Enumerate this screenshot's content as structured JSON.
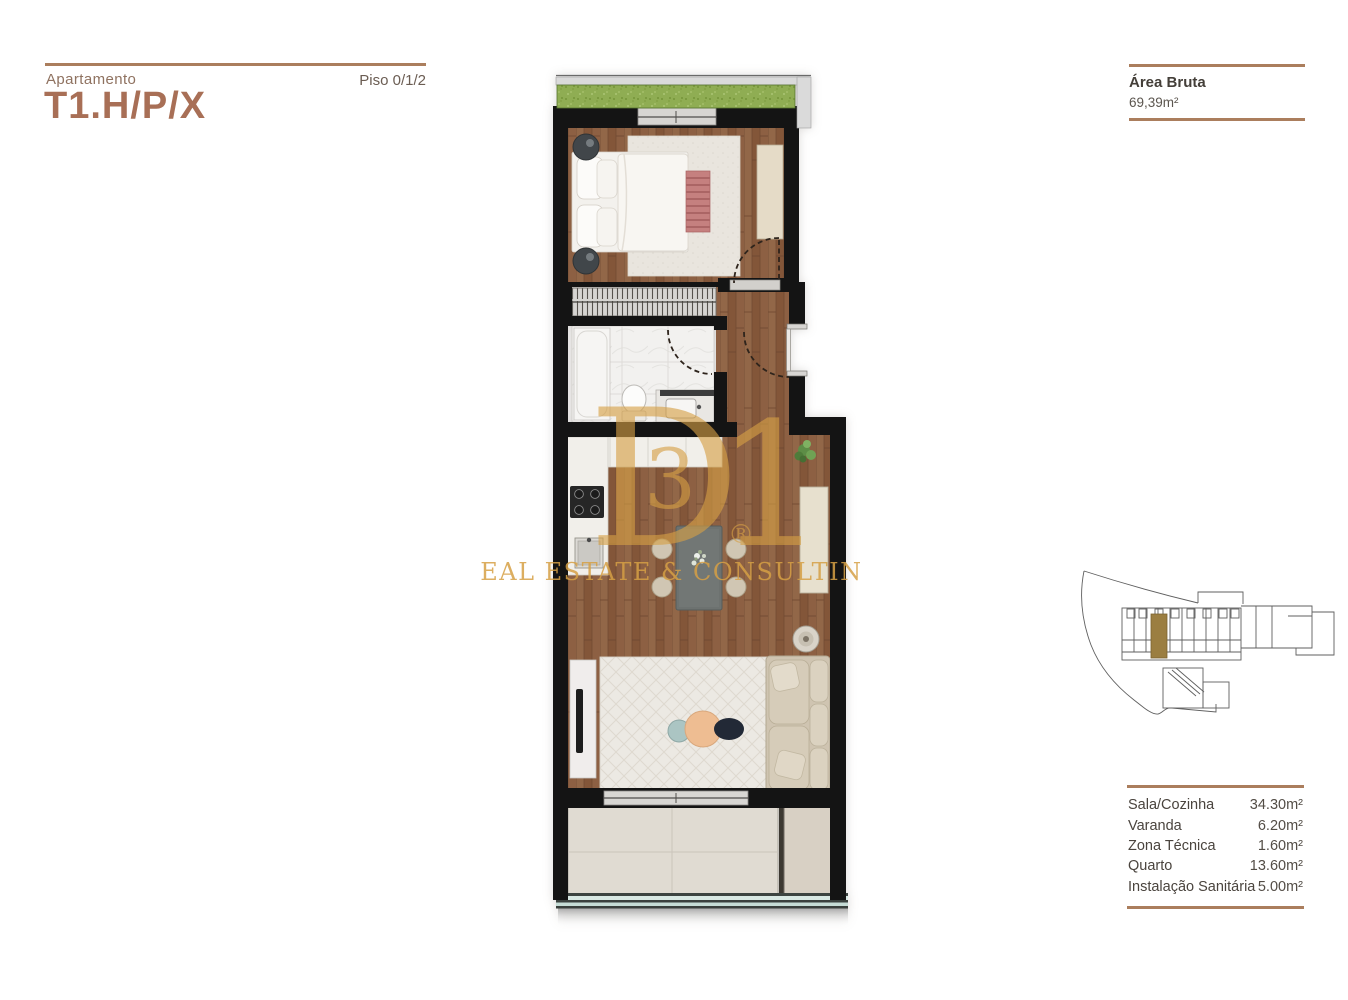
{
  "header": {
    "apartment_label": "Apartamento",
    "apartment_title": "T1.H/P/X",
    "floor_label": "Piso 0/1/2"
  },
  "gross_area": {
    "label": "Área Bruta",
    "value": "69,39m²"
  },
  "areas_table": {
    "rows": [
      {
        "label": "Sala/Cozinha",
        "value": "34.30m²"
      },
      {
        "label": "Varanda",
        "value": "6.20m²"
      },
      {
        "label": "Zona Técnica",
        "value": "1.60m²"
      },
      {
        "label": "Quarto",
        "value": "13.60m²"
      },
      {
        "label": "Instalação Sanitária",
        "value": "5.00m²"
      }
    ]
  },
  "watermark": {
    "letter_d": "D",
    "letter_3": "3",
    "letter_1": "1",
    "registered_mark": "®",
    "tagline": "REAL ESTATE & CONSULTING",
    "color": "#d6a045"
  },
  "colors": {
    "accent_brown": "#a86f56",
    "divider_brown": "#ab7e5d",
    "wall_black": "#141414",
    "wood_floor": "#8b5e40",
    "green_roof": "#8fad53",
    "site_highlight": "#9b7e41"
  },
  "floor_plan": {
    "rooms": [
      "bedroom",
      "closet",
      "bathroom",
      "hallway",
      "kitchen-dining-living",
      "balcony",
      "technical-zone"
    ],
    "furniture": [
      "double-bed",
      "nightstands",
      "wardrobe",
      "shower",
      "toilet",
      "vanity-sink",
      "kitchen-counter",
      "cooktop",
      "kitchen-sink",
      "dining-table",
      "dining-chairs",
      "sideboard",
      "plant",
      "side-table",
      "tv-console",
      "sofa",
      "coffee-tables",
      "rugs"
    ]
  },
  "site_plan": {
    "description": "building-location-map"
  }
}
